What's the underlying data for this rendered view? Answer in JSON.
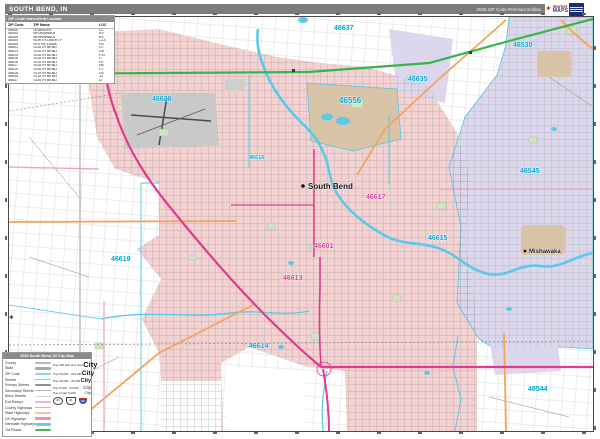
{
  "title_bar": {
    "title": "SOUTH BEND, IN",
    "edition": "2026 ZIP Code Premium Edition"
  },
  "logo": {
    "mark": "✶",
    "brand_top": "Market",
    "brand_bottom": "MAPS"
  },
  "zip_index": {
    "title": "ZIP Code Index/Grid Locator",
    "headers": [
      "ZIP Code",
      "ZIP Name",
      "LOC"
    ],
    "rows": [
      {
        "zip": "46530",
        "name": "GRANGER",
        "loc": "L2"
      },
      {
        "zip": "46544",
        "name": "MISHAWAKA",
        "loc": "K9"
      },
      {
        "zip": "46545",
        "name": "MISHAWAKA",
        "loc": "K6"
      },
      {
        "zip": "46554",
        "name": "NORTH LIBERTY",
        "loc": "C14"
      },
      {
        "zip": "46556",
        "name": "NOTRE DAME",
        "loc": "H3"
      },
      {
        "zip": "46601",
        "name": "SOUTH BEND",
        "loc": "G7"
      },
      {
        "zip": "46613",
        "name": "SOUTH BEND",
        "loc": "G9"
      },
      {
        "zip": "46614",
        "name": "SOUTH BEND",
        "loc": "F11"
      },
      {
        "zip": "46615",
        "name": "SOUTH BEND",
        "loc": "I7"
      },
      {
        "zip": "46616",
        "name": "SOUTH BEND",
        "loc": "F5"
      },
      {
        "zip": "46617",
        "name": "SOUTH BEND",
        "loc": "H6"
      },
      {
        "zip": "46619",
        "name": "SOUTH BEND",
        "loc": "C7"
      },
      {
        "zip": "46628",
        "name": "SOUTH BEND",
        "loc": "D4"
      },
      {
        "zip": "46635",
        "name": "SOUTH BEND",
        "loc": "J3"
      },
      {
        "zip": "46637",
        "name": "SOUTH BEND",
        "loc": "I2"
      }
    ]
  },
  "map": {
    "zip_labels": [
      {
        "text": "46637",
        "color": "#00a8d8"
      },
      {
        "text": "46530",
        "color": "#00a8d8"
      },
      {
        "text": "46635",
        "color": "#00a8d8"
      },
      {
        "text": "46556",
        "color": "#00a8d8"
      },
      {
        "text": "46628",
        "color": "#00a8d8"
      },
      {
        "text": "46545",
        "color": "#00a8d8"
      },
      {
        "text": "46617",
        "color": "#e0399a"
      },
      {
        "text": "46616",
        "color": "#00a8d8"
      },
      {
        "text": "46601",
        "color": "#e0399a"
      },
      {
        "text": "46619",
        "color": "#00a8d8"
      },
      {
        "text": "46615",
        "color": "#00a8d8"
      },
      {
        "text": "46613",
        "color": "#e0399a"
      },
      {
        "text": "46614",
        "color": "#00a8d8"
      },
      {
        "text": "46544",
        "color": "#00a8d8"
      }
    ],
    "city_labels": [
      {
        "text": "South Bend"
      },
      {
        "text": "Mishawaka"
      }
    ]
  },
  "legend": {
    "title": "2026 South Bend, IN City Map",
    "items": [
      {
        "label": "County"
      },
      {
        "label": "State"
      },
      {
        "label": "ZIP Code"
      },
      {
        "label": "Streets"
      },
      {
        "label": "Primary Streets"
      },
      {
        "label": "Secondary Streets"
      },
      {
        "label": "Minor Streets"
      },
      {
        "label": "Exit Ramps"
      },
      {
        "label": "County Highways"
      },
      {
        "label": "State Highways"
      },
      {
        "label": "US Highways"
      },
      {
        "label": "Interstate Highways"
      },
      {
        "label": "Toll Roads"
      }
    ],
    "population": [
      {
        "label": "Pop 250,000 and Over",
        "sample": "City"
      },
      {
        "label": "Pop 50,000 - 249,999",
        "sample": "City"
      },
      {
        "label": "Pop 25,000 - 49,999",
        "sample": "City"
      },
      {
        "label": "Pop 5,000 - 24,999",
        "sample": "City"
      },
      {
        "label": "Pop Under 5,000",
        "sample": "City"
      }
    ],
    "shields": [
      {
        "type": "state-highway-shield",
        "num": "23"
      },
      {
        "type": "us-highway-shield",
        "num": "31"
      },
      {
        "type": "interstate-shield",
        "num": "80"
      }
    ]
  },
  "colors": {
    "zip_fill_pink": "#f4d2d2",
    "zip_fill_lavender": "#dcd7ec",
    "campus_tan": "#d9c4a8",
    "airport_gray": "#c9c9c9",
    "water": "#5cc8ea",
    "toll_green": "#35b54a",
    "us_hwy_magenta": "#e23a8e",
    "state_hwy_orange": "#f2a558",
    "label_cyan": "#00a8d8",
    "label_magenta": "#e0399a",
    "title_bar_gray": "#7c7c7c"
  }
}
